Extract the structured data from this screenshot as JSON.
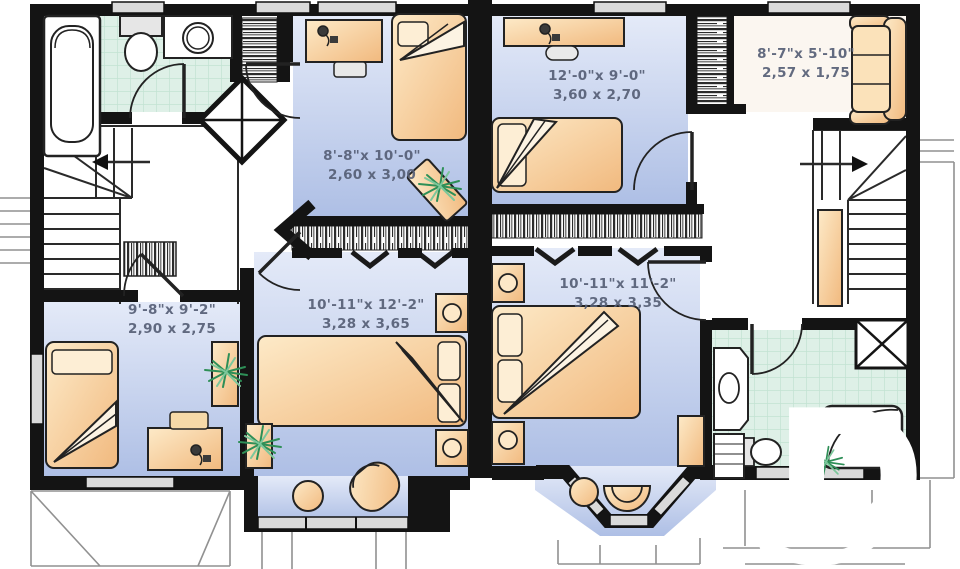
{
  "plan": {
    "type": "second-floor-duplex-plan",
    "watermark": {
      "letter": "D"
    },
    "colors": {
      "wall": "#141414",
      "room_floor_top": "#e4eaf8",
      "room_floor_bottom": "#aebfe5",
      "bath_tile": "#def0e7",
      "furniture_light": "#fdeac8",
      "furniture_dark": "#f1b97e",
      "window_glass": "#dadada",
      "label_text": "#565f76",
      "plant_green": "#2e8f57",
      "watermark_color": "#ffffff"
    }
  },
  "rooms": [
    {
      "id": "bedroom-upper-left",
      "imperial": "8'-8\"x 10'-0\"",
      "metric": "2,60 x 3,00"
    },
    {
      "id": "bedroom-upper-right",
      "imperial": "12'-0\"x 9'-0\"",
      "metric": "3,60 x 2,70"
    },
    {
      "id": "sitting-area-right",
      "imperial": "8'-7\"x 5'-10\"",
      "metric": "2,57 x 1,75"
    },
    {
      "id": "bedroom-lower-left",
      "imperial": "9'-8\"x 9'-2\"",
      "metric": "2,90 x 2,75"
    },
    {
      "id": "bedroom-master-left",
      "imperial": "10'-11\"x 12'-2\"",
      "metric": "3,28 x 3,65"
    },
    {
      "id": "bedroom-master-right",
      "imperial": "10'-11\"x 11'-2\"",
      "metric": "3,28 x 3,35"
    }
  ]
}
